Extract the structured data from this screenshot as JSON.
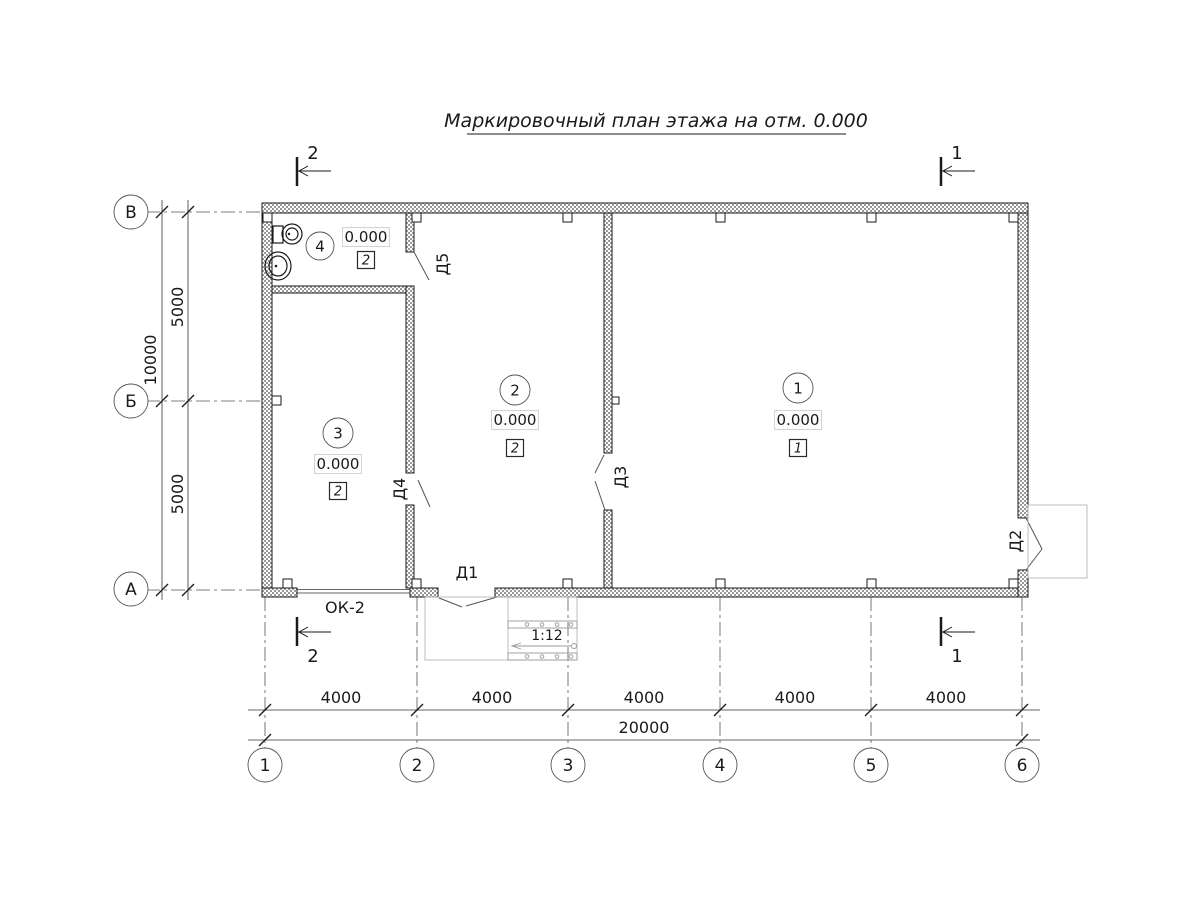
{
  "title": {
    "text": "Маркировочный план этажа на отм. 0.000"
  },
  "axes": {
    "rows": [
      {
        "label": "В"
      },
      {
        "label": "Б"
      },
      {
        "label": "А"
      }
    ],
    "cols": [
      {
        "label": "1"
      },
      {
        "label": "2"
      },
      {
        "label": "3"
      },
      {
        "label": "4"
      },
      {
        "label": "5"
      },
      {
        "label": "6"
      }
    ]
  },
  "dimensions": {
    "bottom_segments": [
      "4000",
      "4000",
      "4000",
      "4000",
      "4000"
    ],
    "bottom_total": "20000",
    "left_segments": [
      "5000",
      "5000"
    ],
    "left_total": "10000"
  },
  "rooms": [
    {
      "number": "1",
      "elevation": "0.000",
      "floor_type": "1"
    },
    {
      "number": "2",
      "elevation": "0.000",
      "floor_type": "2"
    },
    {
      "number": "3",
      "elevation": "0.000",
      "floor_type": "2"
    },
    {
      "number": "4",
      "elevation": "0.000",
      "floor_type": "2"
    }
  ],
  "doors": [
    {
      "label": "Д1"
    },
    {
      "label": "Д2"
    },
    {
      "label": "Д3"
    },
    {
      "label": "Д4"
    },
    {
      "label": "Д5"
    }
  ],
  "window": {
    "label": "ОК-2"
  },
  "ramp": {
    "slope": "1:12"
  },
  "sections": [
    {
      "label": "1"
    },
    {
      "label": "2"
    }
  ],
  "colors": {
    "line": "#1a1a1a",
    "wall_hatch": "#999999",
    "light_line": "#b5b5b5"
  }
}
